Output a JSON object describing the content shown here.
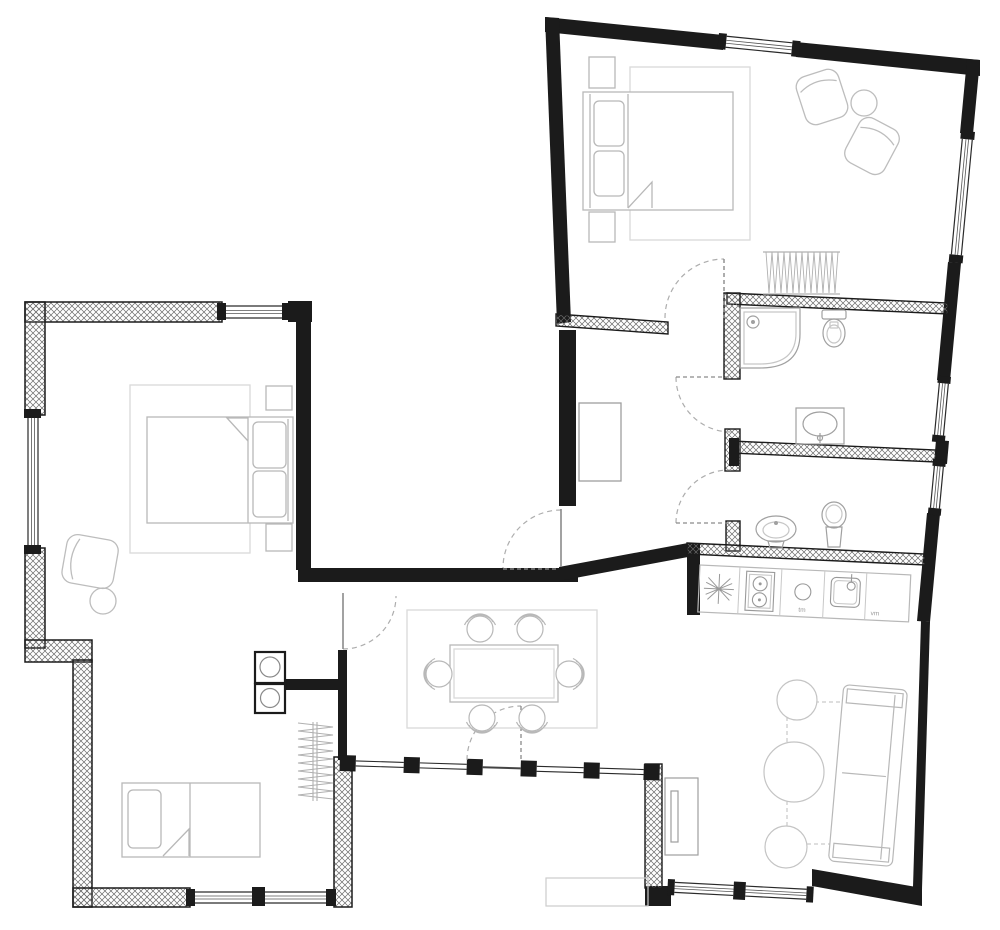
{
  "plan": {
    "type": "residential-floor-plan",
    "colors": {
      "wall": "#1b1b1b",
      "hatch": "#666666",
      "furniture": "#bdbdbd",
      "fixture": "#a0a0a0",
      "rug": "#d9d9d9",
      "door_arc": "#adadad",
      "background": "#ffffff"
    },
    "kitchen": {
      "label_tm": "tm",
      "label_vm": "vm",
      "appliances": [
        "burst-symbol",
        "cooktop-two-burner",
        "round-basin",
        "square-sink"
      ]
    },
    "rooms": [
      {
        "name": "master-bedroom",
        "position": "top-right",
        "furniture": [
          "double-bed",
          "two-pillows",
          "nightstand",
          "nightstand",
          "armchair",
          "armchair",
          "round-side-table",
          "area-rug",
          "wardrobe-hanging-rail"
        ]
      },
      {
        "name": "bedroom-left",
        "position": "middle-left",
        "furniture": [
          "double-bed",
          "two-pillows",
          "nightstand",
          "nightstand",
          "armchair",
          "round-side-table",
          "area-rug"
        ]
      },
      {
        "name": "kids-room",
        "position": "bottom-left",
        "furniture": [
          "single-bed",
          "pillow",
          "wardrobe-hanging-rail",
          "washer-dryer-stack"
        ]
      },
      {
        "name": "hall",
        "position": "center",
        "furniture": [
          "cabinet"
        ]
      },
      {
        "name": "bathroom-1",
        "position": "right-middle",
        "furniture": [
          "corner-shower",
          "toilet",
          "washbasin"
        ]
      },
      {
        "name": "bathroom-2",
        "position": "right-middle-lower",
        "furniture": [
          "bidet",
          "toilet"
        ]
      },
      {
        "name": "kitchen",
        "position": "right-center",
        "furniture": [
          "counter",
          "cooktop",
          "sink",
          "basin"
        ]
      },
      {
        "name": "dining-area",
        "position": "center-bottom",
        "furniture": [
          "dining-table",
          "chair",
          "chair",
          "chair",
          "chair",
          "chair",
          "chair",
          "area-rug"
        ]
      },
      {
        "name": "living-room",
        "position": "bottom-right",
        "furniture": [
          "sofa",
          "round-table",
          "round-table",
          "round-table",
          "tv-cabinet",
          "terrace-step"
        ]
      }
    ],
    "openings": {
      "windows": 9,
      "doors": [
        "master-bedroom-door",
        "bathroom-1-door",
        "bathroom-2-door",
        "hall-door",
        "kids-room-door",
        "entrance-door"
      ]
    }
  }
}
